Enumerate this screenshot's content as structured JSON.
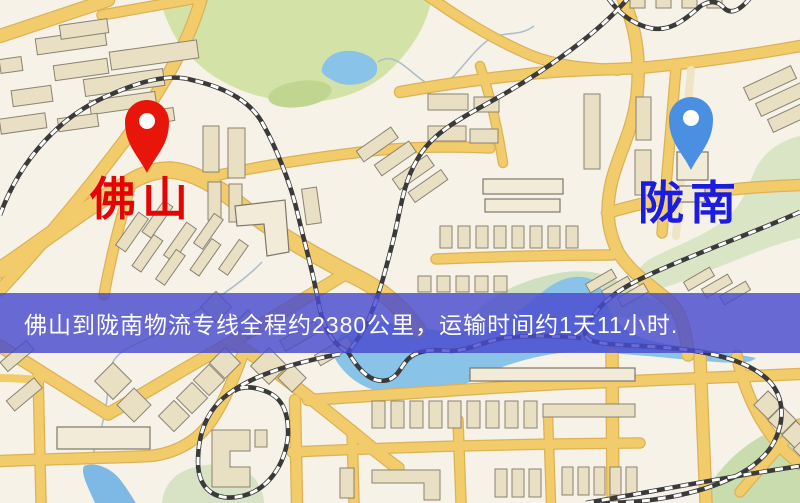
{
  "origin": {
    "label": "佛山",
    "pin_color": "#e8150b",
    "label_color": "#e60303"
  },
  "destination": {
    "label": "陇南",
    "pin_color": "#4a8fe2",
    "label_color": "#1c1ce0"
  },
  "banner": {
    "text": "佛山到陇南物流专线全程约2380公里，运输时间约1天11小时.",
    "distance_km": "2380",
    "duration": "1天11小时",
    "bg_color": "rgba(72,74,206,0.82)",
    "text_color": "#ffffff"
  },
  "map": {
    "colors": {
      "background": "#f6f2e8",
      "road": "#f2cc6a",
      "road_casing": "#ddb157",
      "building": "#e9e0c3",
      "park_green": "#d3e3a8",
      "water_blue": "#8ac3e8",
      "railway": "#3a3a3a"
    },
    "icons": [
      "origin-pin-icon",
      "destination-pin-icon"
    ]
  }
}
